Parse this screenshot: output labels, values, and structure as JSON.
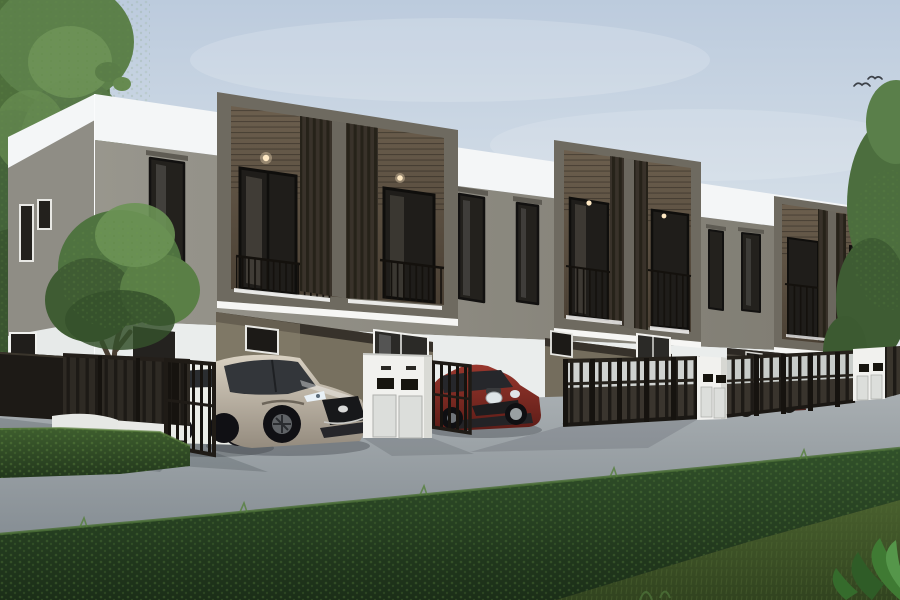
{
  "scene": {
    "title": "3D exterior rendering: modern two-storey townhouse row with carports, parked cars, dark metal fence, mailbox pillars, hedges and trees under a pale blue sky",
    "time_of_day": "day",
    "objects": {
      "building": "three-unit townhome row; white parapet roof band, warm grey upper walls, dark bronze projecting balcony boxes with vertical slat screens and thin railings, recessed ground-floor carports",
      "vehicles": [
        "white sedan",
        "champagne-silver SUV",
        "dark red hatchback",
        "dark car behind fence"
      ],
      "streetscape": [
        "dark vertical-bar fence on low white wall",
        "open gate leaves",
        "white mailbox pillars with twin letter slots",
        "concrete driveway"
      ],
      "landscape": [
        "tall trees on the left",
        "front-yard tree",
        "trees at right edge",
        "clipped hedge rows",
        "foreground lawn",
        "broadleaf plants in the corner"
      ],
      "sky": [
        "soft clouds",
        "small flying birds"
      ]
    }
  },
  "palette": {
    "sky": "#c7d3e2",
    "wall_white": "#f4f6f7",
    "wall_lower": "#eaedec",
    "wall_grey": "#8e8b82",
    "box_frame": "#6e6a60",
    "box_interior": "#5d5244",
    "slats": "#2c2822",
    "glass": "#211f1c",
    "fence": "#1d1a16",
    "pillar": "#f1f1ee",
    "driveway": "#9aa1a6",
    "hedge": "#2f4d26",
    "grass": "#435a2c",
    "tree": "#517440",
    "car_suv": "#b9b1a3",
    "car_sedan": "#eceee9",
    "car_hatch": "#8a2f27",
    "bird": "#3c4148"
  }
}
